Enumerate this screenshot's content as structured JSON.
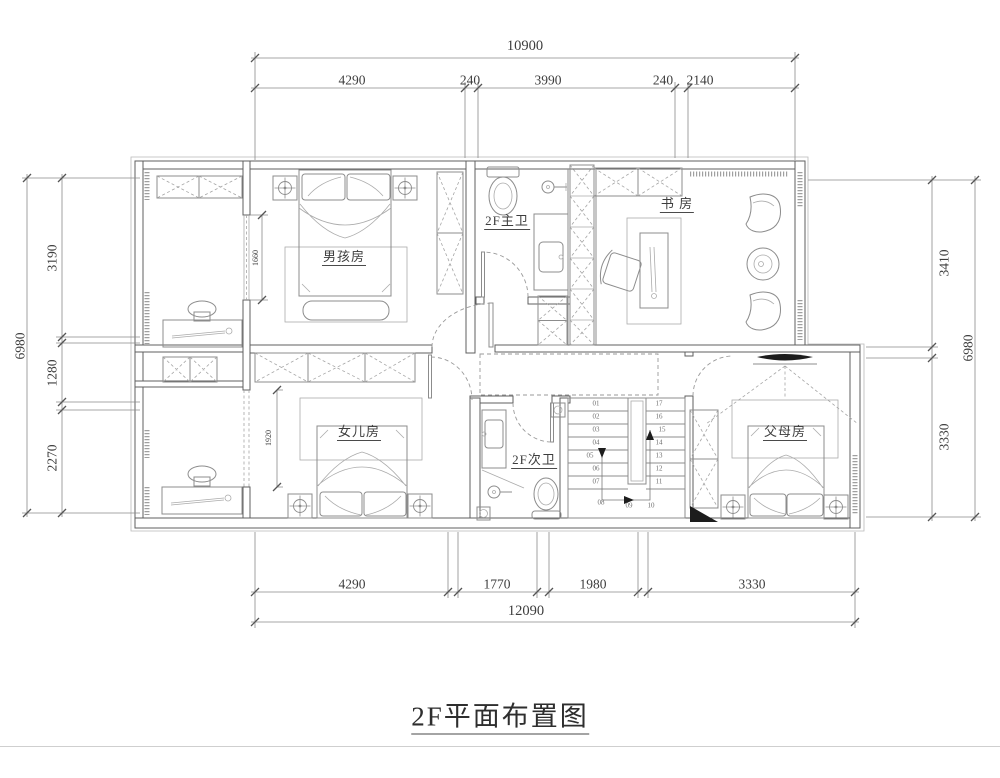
{
  "title": "2F平面布置图",
  "colors": {
    "wall_line": "#5f5f5f",
    "furniture_line": "#8c8c8c",
    "text": "#3d3d3d",
    "black_fill": "#1d1d1d"
  },
  "dims": {
    "top": {
      "overall": "10900",
      "seg1": "4290",
      "seg2": "240",
      "seg3": "3990",
      "seg4": "240",
      "seg5": "2140"
    },
    "bottom": {
      "overall": "12090",
      "seg1": "4290",
      "seg2": "1770",
      "seg3": "1980",
      "seg4": "3330"
    },
    "left": {
      "overall": "6980",
      "seg1": "3190",
      "seg2": "1280",
      "seg3": "2270"
    },
    "right": {
      "overall": "6980",
      "seg1": "3410",
      "seg2": "3330"
    },
    "inner": {
      "boy_window": "1660",
      "daughter_opening": "1920"
    }
  },
  "rooms": {
    "boy": "男孩房",
    "master_bath": "2F主卫",
    "study": "书 房",
    "daughter": "女儿房",
    "second_bath": "2F次卫",
    "parents": "父母房"
  },
  "stairs": {
    "left": [
      "01",
      "02",
      "03",
      "04",
      "05",
      "06",
      "07"
    ],
    "right": [
      "17",
      "16",
      "15",
      "14",
      "13",
      "12",
      "11"
    ],
    "bottom": [
      "08",
      "09",
      "10"
    ]
  }
}
